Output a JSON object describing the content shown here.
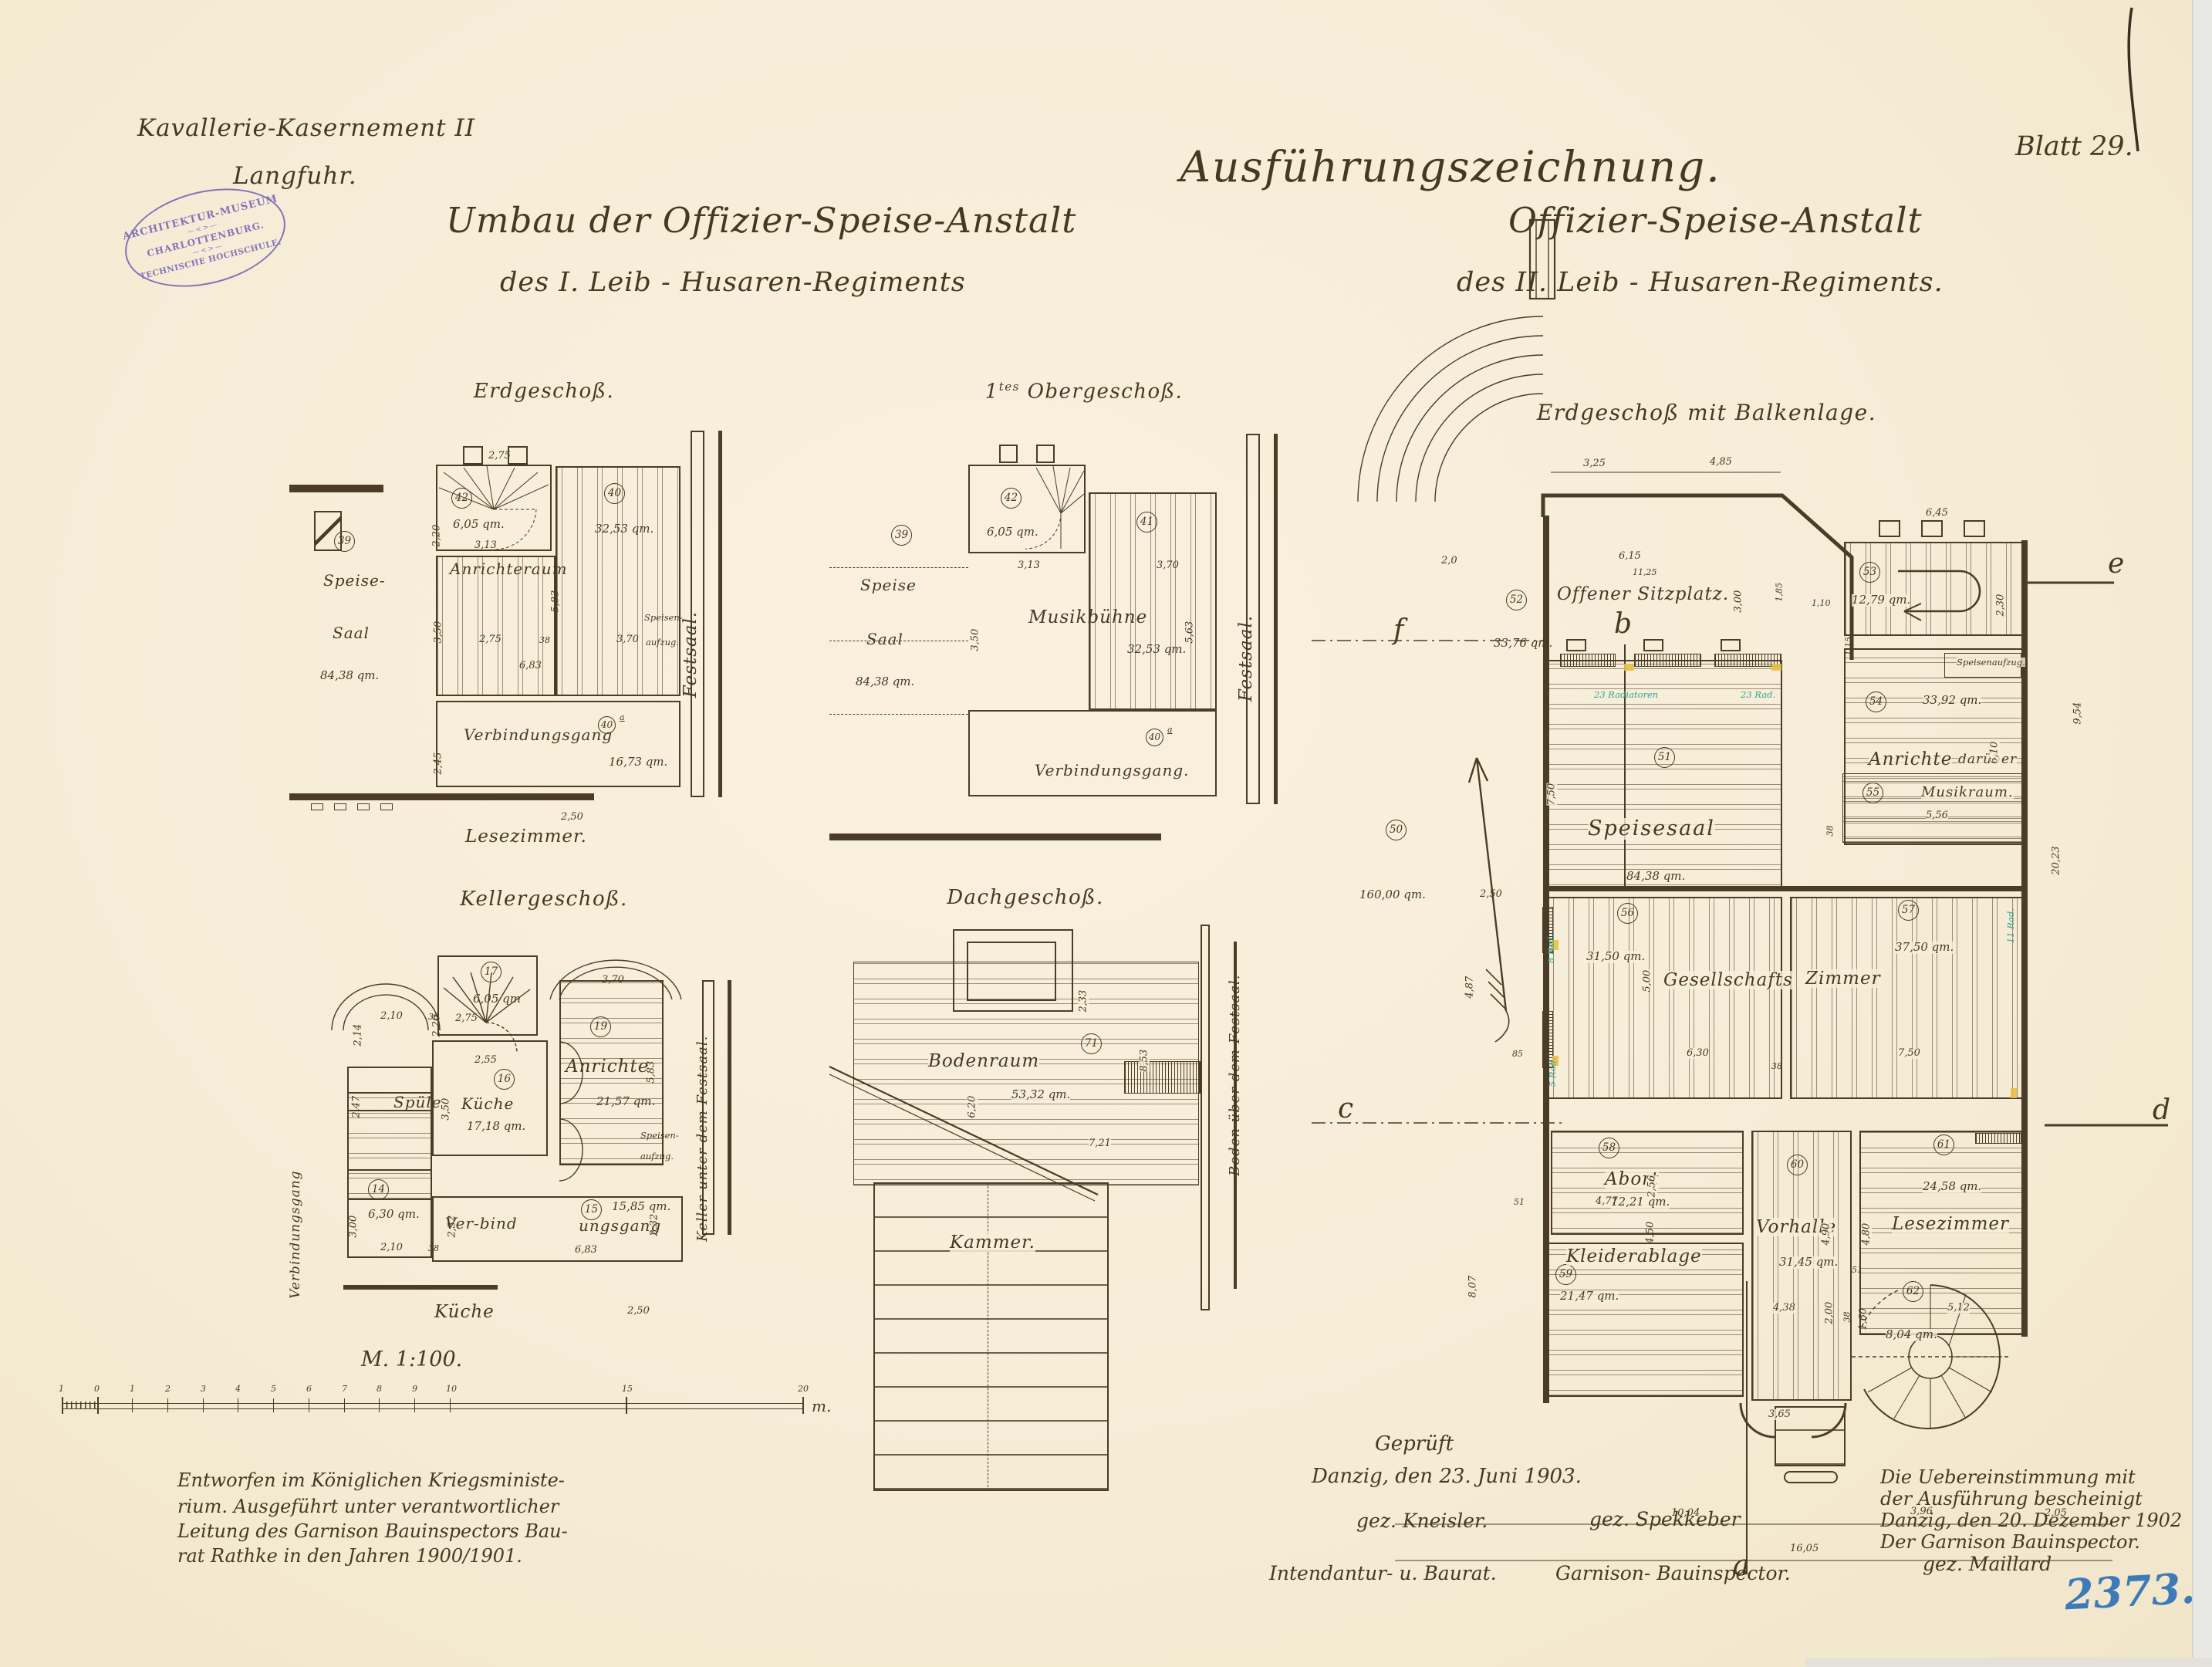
{
  "header": {
    "project_line1": "Kavallerie-Kasernement II",
    "project_line2": "Langfuhr.",
    "main_title": "Ausführungszeichnung.",
    "sheet_label": "Blatt 29.",
    "left_title_line1": "Umbau der Offizier-Speise-Anstalt",
    "left_title_line2": "des I.  Leib - Husaren-Regiments",
    "right_title_line1": "Offizier-Speise-Anstalt",
    "right_title_line2": "des II.   Leib - Husaren-Regiments."
  },
  "stamp": {
    "line1": "ARCHITEKTUR-MUSEUM",
    "line2": "CHARLOTTENBURG.",
    "line3": "TECHNISCHE HOCHSCHULE.",
    "ornament": "—<>—",
    "color": "#6e5fb2"
  },
  "plans": {
    "eg": {
      "title": "Erdgeschoß.",
      "no42": "42",
      "area42": "6,05 qm.",
      "no40": "40",
      "area40": "32,53 qm.",
      "no39": "39",
      "speise1": "Speise-",
      "speise2": "Saal",
      "area39": "84,38 qm.",
      "anrichteraum": "Anrichteraum",
      "no40a": "40",
      "no40a_sup": "a",
      "verbindungsgang": "Verbindungsgang",
      "area40a": "16,73 qm.",
      "lesezimmer": "Lesezimmer.",
      "festsaal": "Festsaal.",
      "speisen": "Speisen-",
      "aufzug": "aufzug.",
      "d275": "2,75",
      "d220": "2,20",
      "d313": "3,13",
      "d583": "5,83",
      "d350": "3,50",
      "d275b": "2,75",
      "d38": "38",
      "d370": "3,70",
      "d683": "6,83",
      "d245": "2,45",
      "d250": "2,50"
    },
    "og": {
      "title_num": "1",
      "title_sup": "tes",
      "title_rest": " Obergeschoß.",
      "no42": "42",
      "area42": "6,05 qm.",
      "no41": "41",
      "musikbuehne": "Musikbühne",
      "area41": "32,53 qm.",
      "no39": "39",
      "speise1": "Speise",
      "speise2": "Saal",
      "area39": "84,38 qm.",
      "no40a": "40",
      "no40a_sup": "a",
      "verbindungsgang": "Verbindungsgang.",
      "festsaal": "Festsaal.",
      "d313": "3,13",
      "d370": "3,70",
      "d350": "3,50",
      "d563": "5,63"
    },
    "kg": {
      "title": "Kellergeschoß.",
      "no17": "17",
      "area17": "6,05 qm",
      "no16": "16",
      "kueche": "Küche",
      "area16": "17,18 qm.",
      "spuele": "Spüle",
      "no19": "19",
      "anrichte": "Anrichte",
      "area19": "21,57 qm.",
      "speisen": "Speisen-",
      "aufzug": "aufzug.",
      "no14": "14",
      "area14": "6,30 qm.",
      "no15": "15",
      "verbind1": "Ver-bind",
      "verbind2": "ungsgang",
      "area15": "15,85 qm.",
      "kueche_unten": "Küche",
      "verbindungsgang": "Verbindungsgang",
      "keller": "Keller unter dem Festsaal.",
      "d220": "2,20",
      "d275": "2,75",
      "d210": "2,10",
      "d38": "38",
      "d214": "2,14",
      "d247": "2,47",
      "d255": "2,55",
      "d350": "3,50",
      "d370": "3,70",
      "d583": "5,83",
      "d300": "3,00",
      "d210b": "2,10",
      "d38b": "38",
      "d232": "2,32",
      "d232b": "2,32",
      "d683": "6,83",
      "d250": "2,50"
    },
    "dg": {
      "title": "Dachgeschoß.",
      "no71": "71",
      "bodenraum": "Bodenraum",
      "area": "53,32 qm.",
      "kammer": "Kammer.",
      "boden": "Boden über dem Festsaal.",
      "d620": "6,20",
      "d233": "2,33",
      "d853": "8,53",
      "d721": "7,21"
    },
    "bk": {
      "title": "Erdgeschoß mit Balkenlage.",
      "no52": "52",
      "sitzplatz": "Offener Sitzplatz.",
      "area52": "33,76 qm.",
      "no53": "53",
      "area53": "12,79 qm.",
      "no51": "51",
      "speisesaal": "Speisesaal",
      "area51": "84,38 qm.",
      "no50": "50",
      "area50": "160,00 qm.",
      "no54": "54",
      "area54": "33,92 qm.",
      "anrichte1": "Anrichte",
      "anrichte2": "darüber",
      "speisenaufzug": "Speisenaufzug.",
      "no55": "55",
      "musikraum": "Musikraum.",
      "no56": "56",
      "area56": "31,50 qm.",
      "gesellschaft": "Gesellschafts",
      "zimmer": "Zimmer",
      "no57": "57",
      "area57": "37,50 qm.",
      "no58": "58",
      "abort": "Abort",
      "area58": "12,21 qm.",
      "no59": "59",
      "kleiderablage": "Kleiderablage",
      "area59": "21,47 qm.",
      "no60": "60",
      "vorhalle": "Vorhalle",
      "area60": "31,45 qm.",
      "no61": "61",
      "lesezimmer": "Lesezimmer",
      "area61": "24,58 qm.",
      "no62": "62",
      "area62": "8,04 qm.",
      "sec_a": "a",
      "sec_b": "b",
      "sec_c": "c",
      "sec_d": "d",
      "sec_e": "e",
      "sec_f": "f",
      "rad23a": "23 Radiatoren",
      "rad23b": "23 Rad.",
      "rad8": "8 Rad.",
      "rad5": "5 Rad.",
      "rad11": "11 Rad.",
      "d325": "3,25",
      "d485": "4,85",
      "d615": "6,15",
      "d1125": "11,25",
      "d20": "2,0",
      "d300": "3,00",
      "d185": "1,85",
      "d110": "1,10",
      "d115": "1,15",
      "d645": "6,45",
      "d230": "2,30",
      "d954": "9,54",
      "d2023": "20,23",
      "d610": "6,10",
      "d556": "5,56",
      "d38a": "38",
      "d38b": "38",
      "d750": "7,50",
      "d250": "2,50",
      "d487": "4,87",
      "d85": "85",
      "d500": "5,00",
      "d630": "6,30",
      "d38c": "38",
      "d750b": "7,50",
      "d256": "2,56",
      "d450": "4,50",
      "d477": "4,77",
      "d51": "51",
      "d51b": "51",
      "d807": "8,07",
      "d490": "4,90",
      "d438": "4,38",
      "d480": "4,80",
      "d512": "5,12",
      "d160": "1,60",
      "d200": "2,00",
      "d365": "3,65",
      "d1004": "10,04",
      "d396": "3,96",
      "d205": "2,05",
      "d1605": "16,05"
    }
  },
  "scalebar": {
    "label": "M. 1:100.",
    "unit": "m.",
    "ticks": [
      "1",
      "0",
      "1",
      "2",
      "3",
      "4",
      "5",
      "6",
      "7",
      "8",
      "9",
      "10",
      "15",
      "20"
    ]
  },
  "notes": {
    "left": {
      "lines": [
        "Entworfen im Königlichen Kriegsministe-",
        "rium.  Ausgeführt unter verantwortlicher",
        "Leitung des Garnison Bauinspectors Bau-",
        "rat Rathke in den Jahren 1900/1901."
      ]
    },
    "center": {
      "gepruft": "Geprüft",
      "date": "Danzig, den 23. Juni 1903.",
      "sig1": "gez. Kneisler.",
      "sig2": "gez. Spekkeber",
      "role1": "Intendantur- u. Baurat.",
      "role2": "Garnison- Bauinspector."
    },
    "right": {
      "lines": [
        "Die Uebereinstimmung mit",
        "der Ausführung bescheinigt",
        "Danzig, den 20. Dezember 1902",
        "Der Garnison Bauinspector.",
        "gez. Maillard"
      ],
      "archive_number": "2373."
    }
  }
}
